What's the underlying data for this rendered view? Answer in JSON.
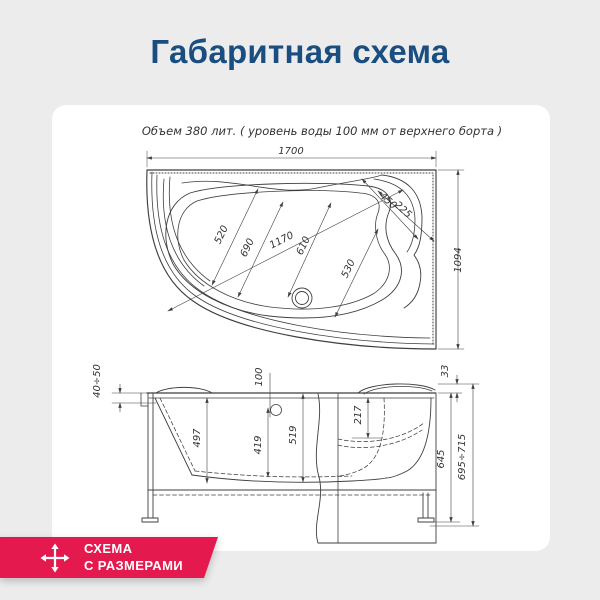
{
  "header": {
    "title": "Габаритная схема"
  },
  "colors": {
    "background": "#ececec",
    "card": "#ffffff",
    "title": "#1a4e80",
    "badge": "#e4194e",
    "drawing_line": "#3f3f3f"
  },
  "drawing": {
    "note": "Объем 380 лит. ( уровень воды 100 мм от верхнего борта )",
    "top_view": {
      "overall_length": "1700",
      "overall_width": "1094",
      "dim_520": "520",
      "dim_690": "690",
      "dim_1170": "1170",
      "dim_610": "610",
      "dim_530": "530",
      "dim_450": "450",
      "dim_225": "225"
    },
    "side_view": {
      "dim_rim_thickness": "40÷50",
      "dim_water_level": "100",
      "dim_33": "33",
      "dim_217": "217",
      "dim_497": "497",
      "dim_419": "419",
      "dim_519": "519",
      "dim_645": "645",
      "dim_height_range": "695÷715"
    }
  },
  "badge": {
    "line1": "СХЕМА",
    "line2": "С РАЗМЕРАМИ",
    "icon": "move-arrows-icon"
  }
}
